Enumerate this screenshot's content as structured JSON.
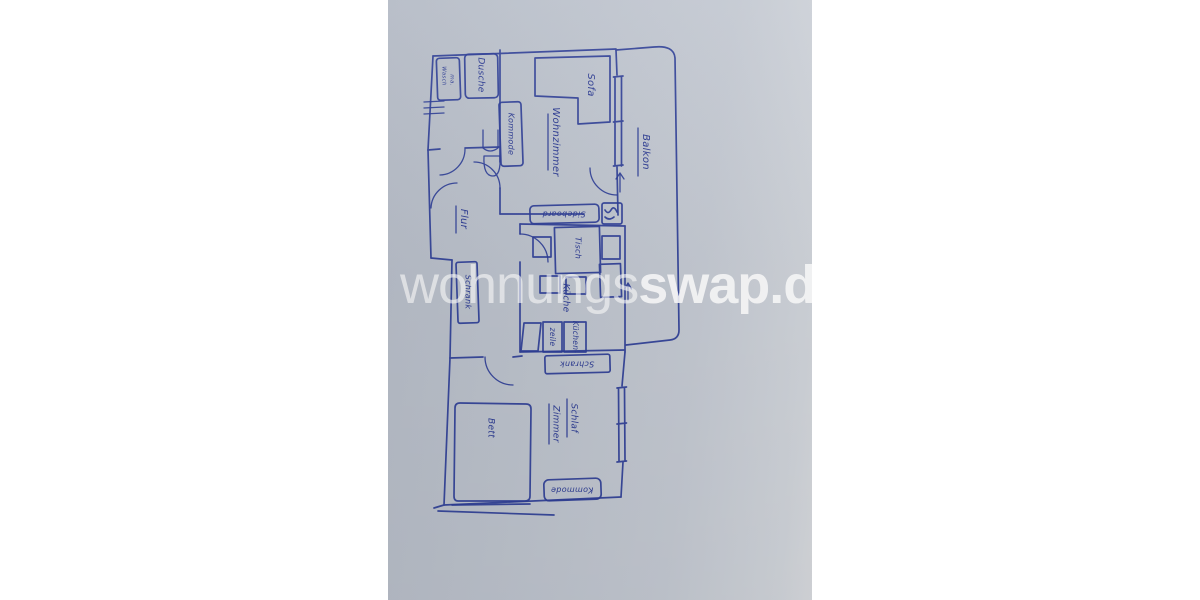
{
  "watermark": {
    "normal": "wohnungs",
    "bold": "swap.de"
  },
  "plan": {
    "ink_color": "#2e3e96",
    "paper_color": "#bfc5ce",
    "rooms": {
      "wohnzimmer": "Wohnzimmer",
      "balkon": "Balkon",
      "flur": "Flur",
      "kueche": "Küche",
      "schlafzimmer_line1": "Schlaf",
      "schlafzimmer_line2": "Zimmer"
    },
    "furniture": {
      "sofa": "Sofa",
      "kommode_wohnzimmer": "Kommode",
      "dusche": "Dusche",
      "waschmaschine_line1": "Wasch",
      "waschmaschine_line2": "ma.",
      "schrank_flur": "Schrank",
      "sideboard": "Sideboard",
      "tisch": "Tisch",
      "kuechenzeile_line1": "Küchen-",
      "kuechenzeile_line2": "zeile",
      "schrank_schlafzimmer": "Schrank",
      "bett": "Bett",
      "kommode_schlafzimmer": "Kommode"
    }
  }
}
